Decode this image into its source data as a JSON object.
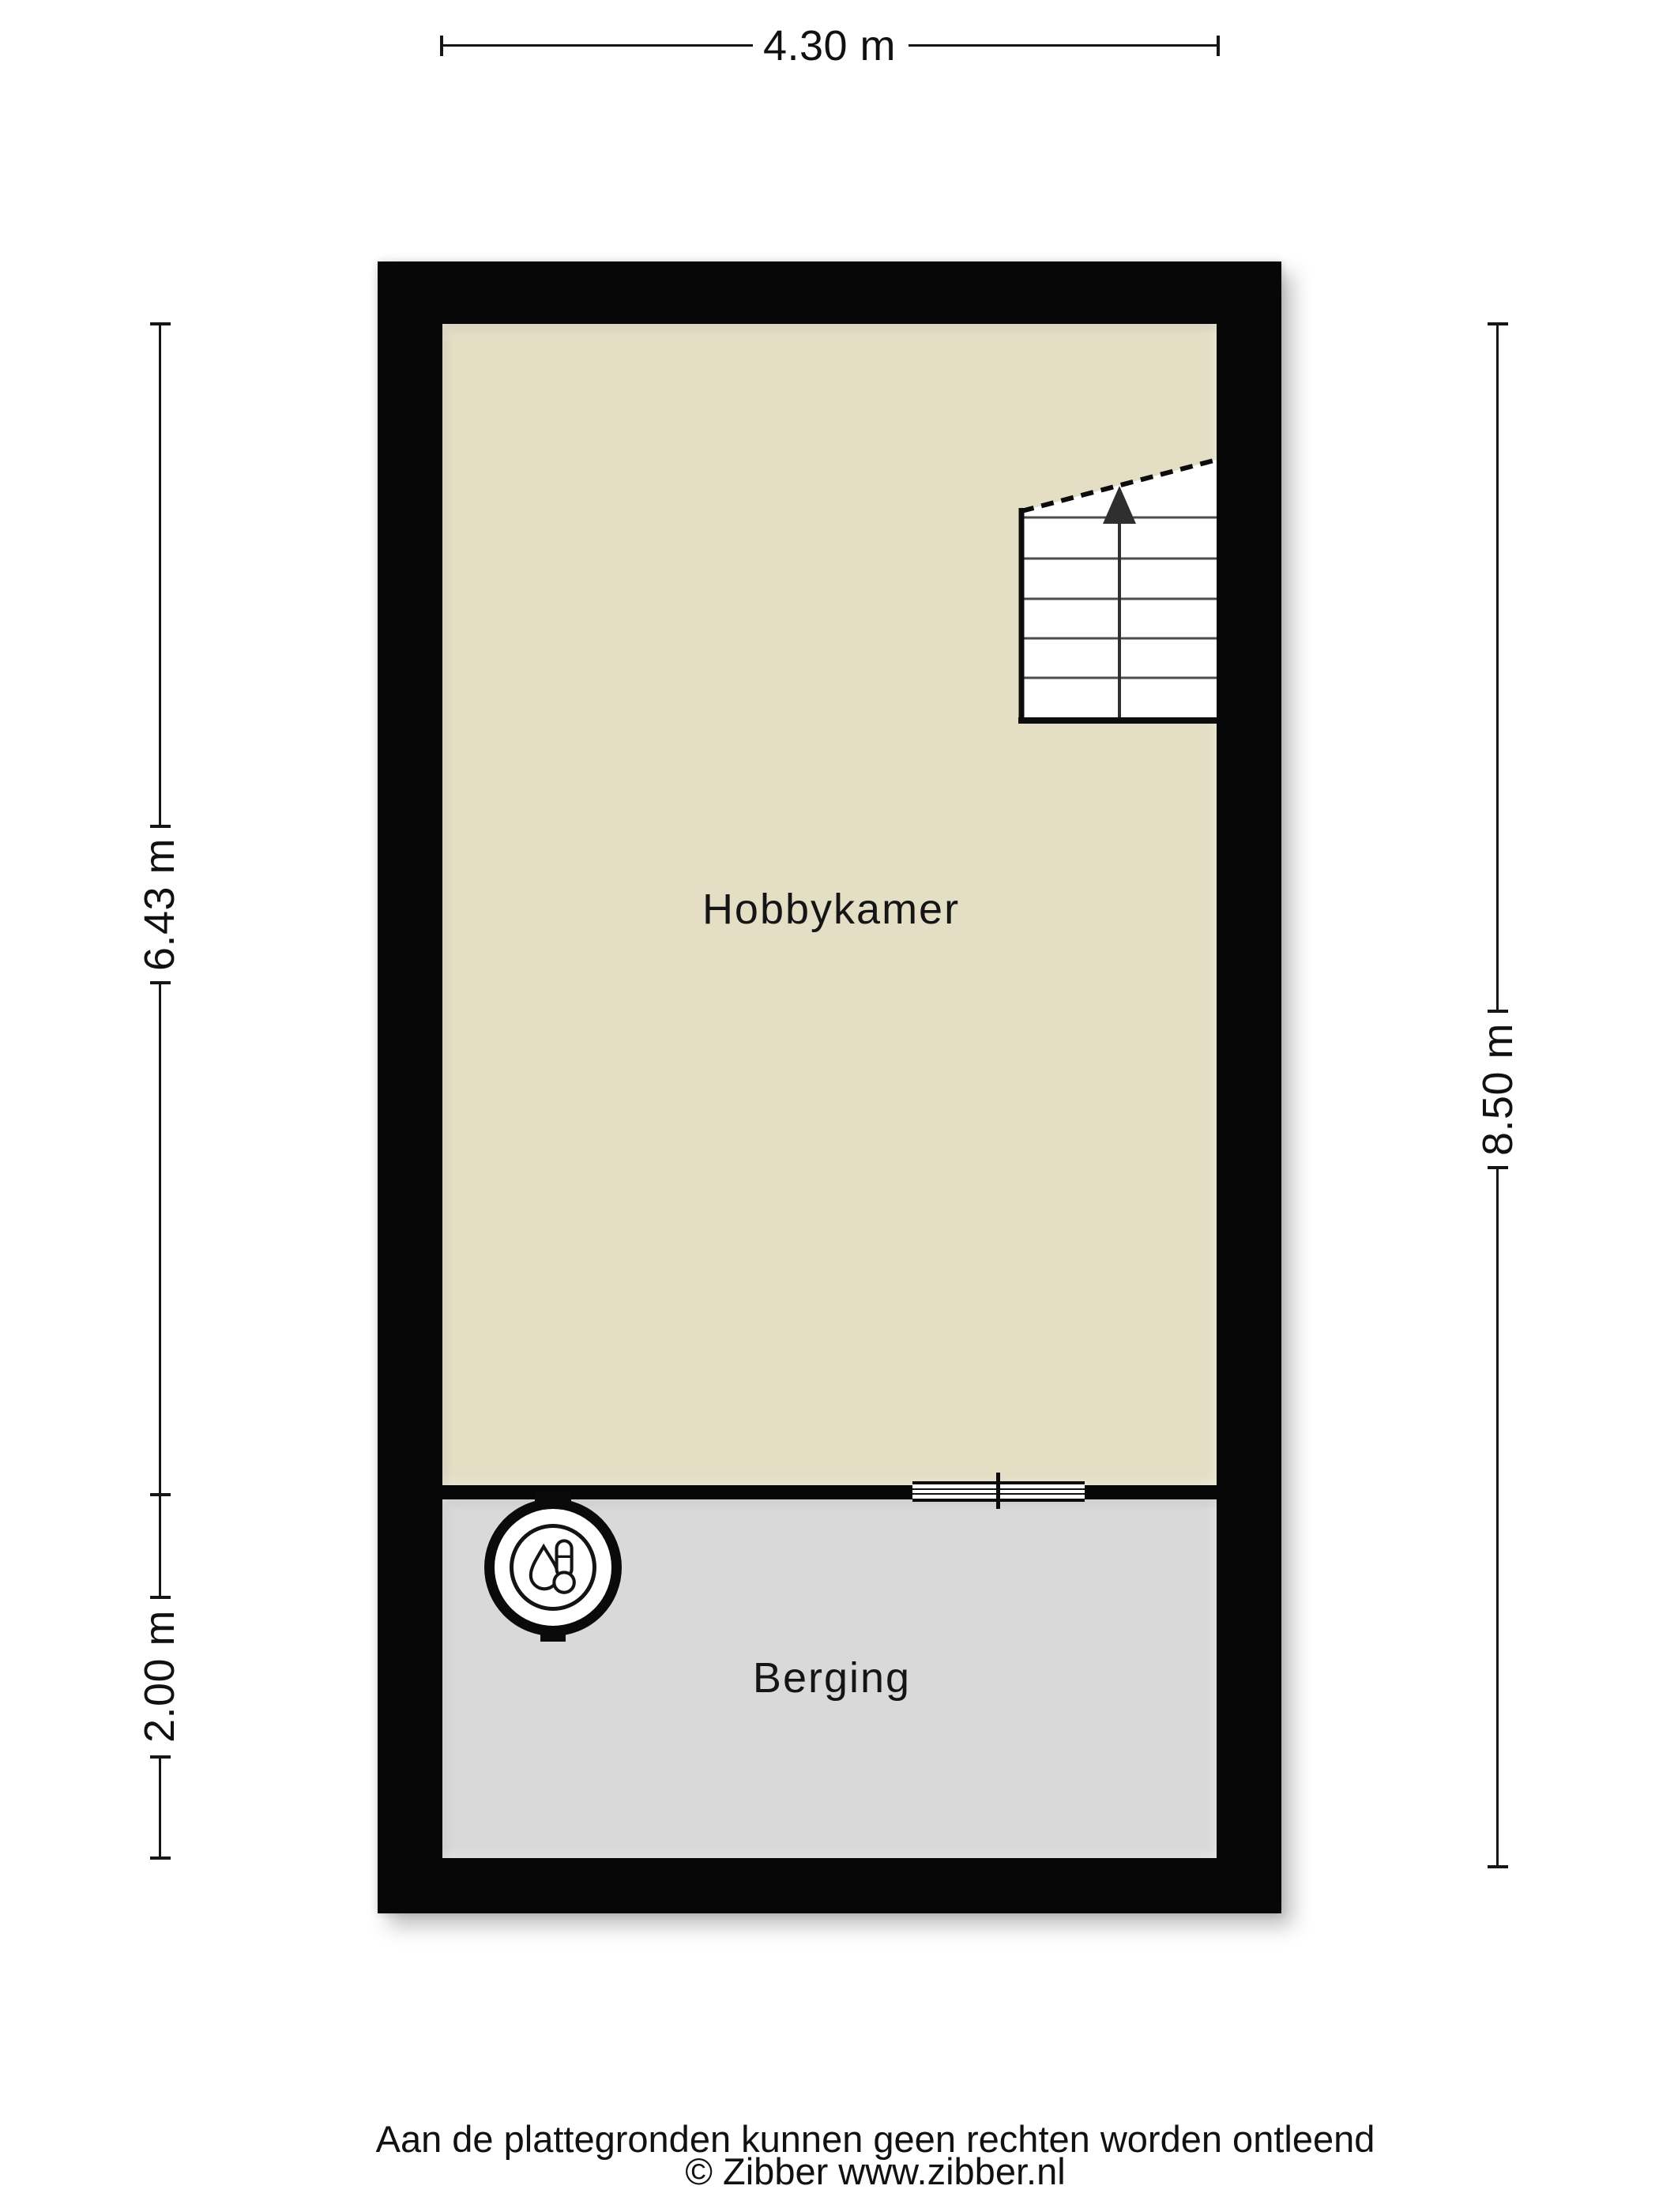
{
  "floorplan": {
    "wall_color": "#070707",
    "rooms": [
      {
        "label": "Hobbykamer",
        "floor_color": "#e4dec5"
      },
      {
        "label": "Berging",
        "floor_color": "#d9d9d9"
      }
    ],
    "stairs": {
      "direction": "up"
    },
    "icons": [
      "stairs-icon",
      "boiler-thermometer-icon",
      "window-marker"
    ]
  },
  "dimensions": {
    "top": "4.30 m",
    "left_upper": "6.43 m",
    "left_lower": "2.00 m",
    "right": "8.50 m"
  },
  "footer": {
    "disclaimer": "Aan de plattegronden kunnen geen rechten worden ontleend",
    "copyright": "© Zibber www.zibber.nl"
  }
}
